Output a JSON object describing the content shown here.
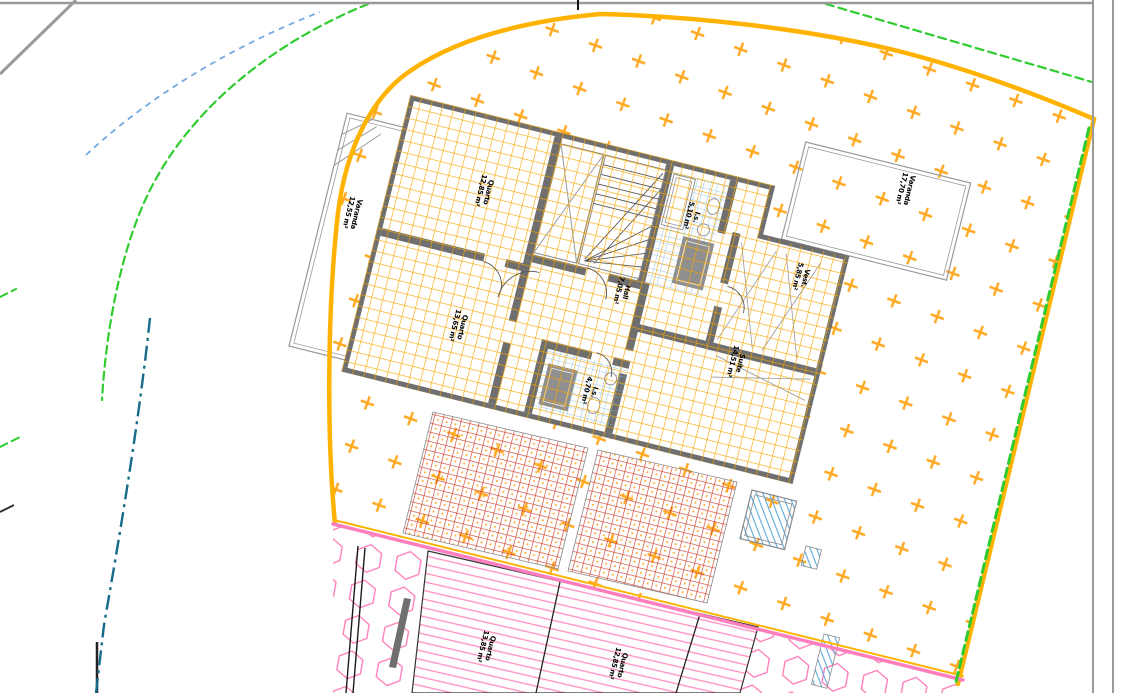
{
  "rooms": [
    {
      "name": "Varanda",
      "area": "12,55 m²"
    },
    {
      "name": "Quarto",
      "area": "12,85 m²"
    },
    {
      "name": "Quarto",
      "area": "13,65 m²"
    },
    {
      "name": "I.s.",
      "area": "5,10 m²"
    },
    {
      "name": "Vest.",
      "area": "5,85 m²"
    },
    {
      "name": "Hall",
      "area": "7,05 m²"
    },
    {
      "name": "I.s.",
      "area": "4,70 m²"
    },
    {
      "name": "Suíte",
      "area": "14,51 m²"
    },
    {
      "name": "Varanda",
      "area": "17,70 m²"
    },
    {
      "name": "Quarto",
      "area": "13,85 m²"
    },
    {
      "name": "Quarto",
      "area": "12,85 m²"
    }
  ],
  "colors": {
    "site_boundary": "#FFB300",
    "site_hatch": "#FFA820",
    "tile_grid": "#F6A600",
    "walls": "#6F6F6F",
    "bath_tile": "#7FBCE6",
    "brick": "#D0402C",
    "brick_dot": "#FFA820",
    "pink": "#FF7EBE",
    "pink_hatch": "#FF8CC2",
    "hex_pink": "#FF74B4",
    "plot_green": "#2FCC2F",
    "road_gray": "#9A9A9A",
    "water_blue": "#5FA8D8",
    "centerline_teal": "#176B8A",
    "dashed_blue": "#74A9E0"
  }
}
